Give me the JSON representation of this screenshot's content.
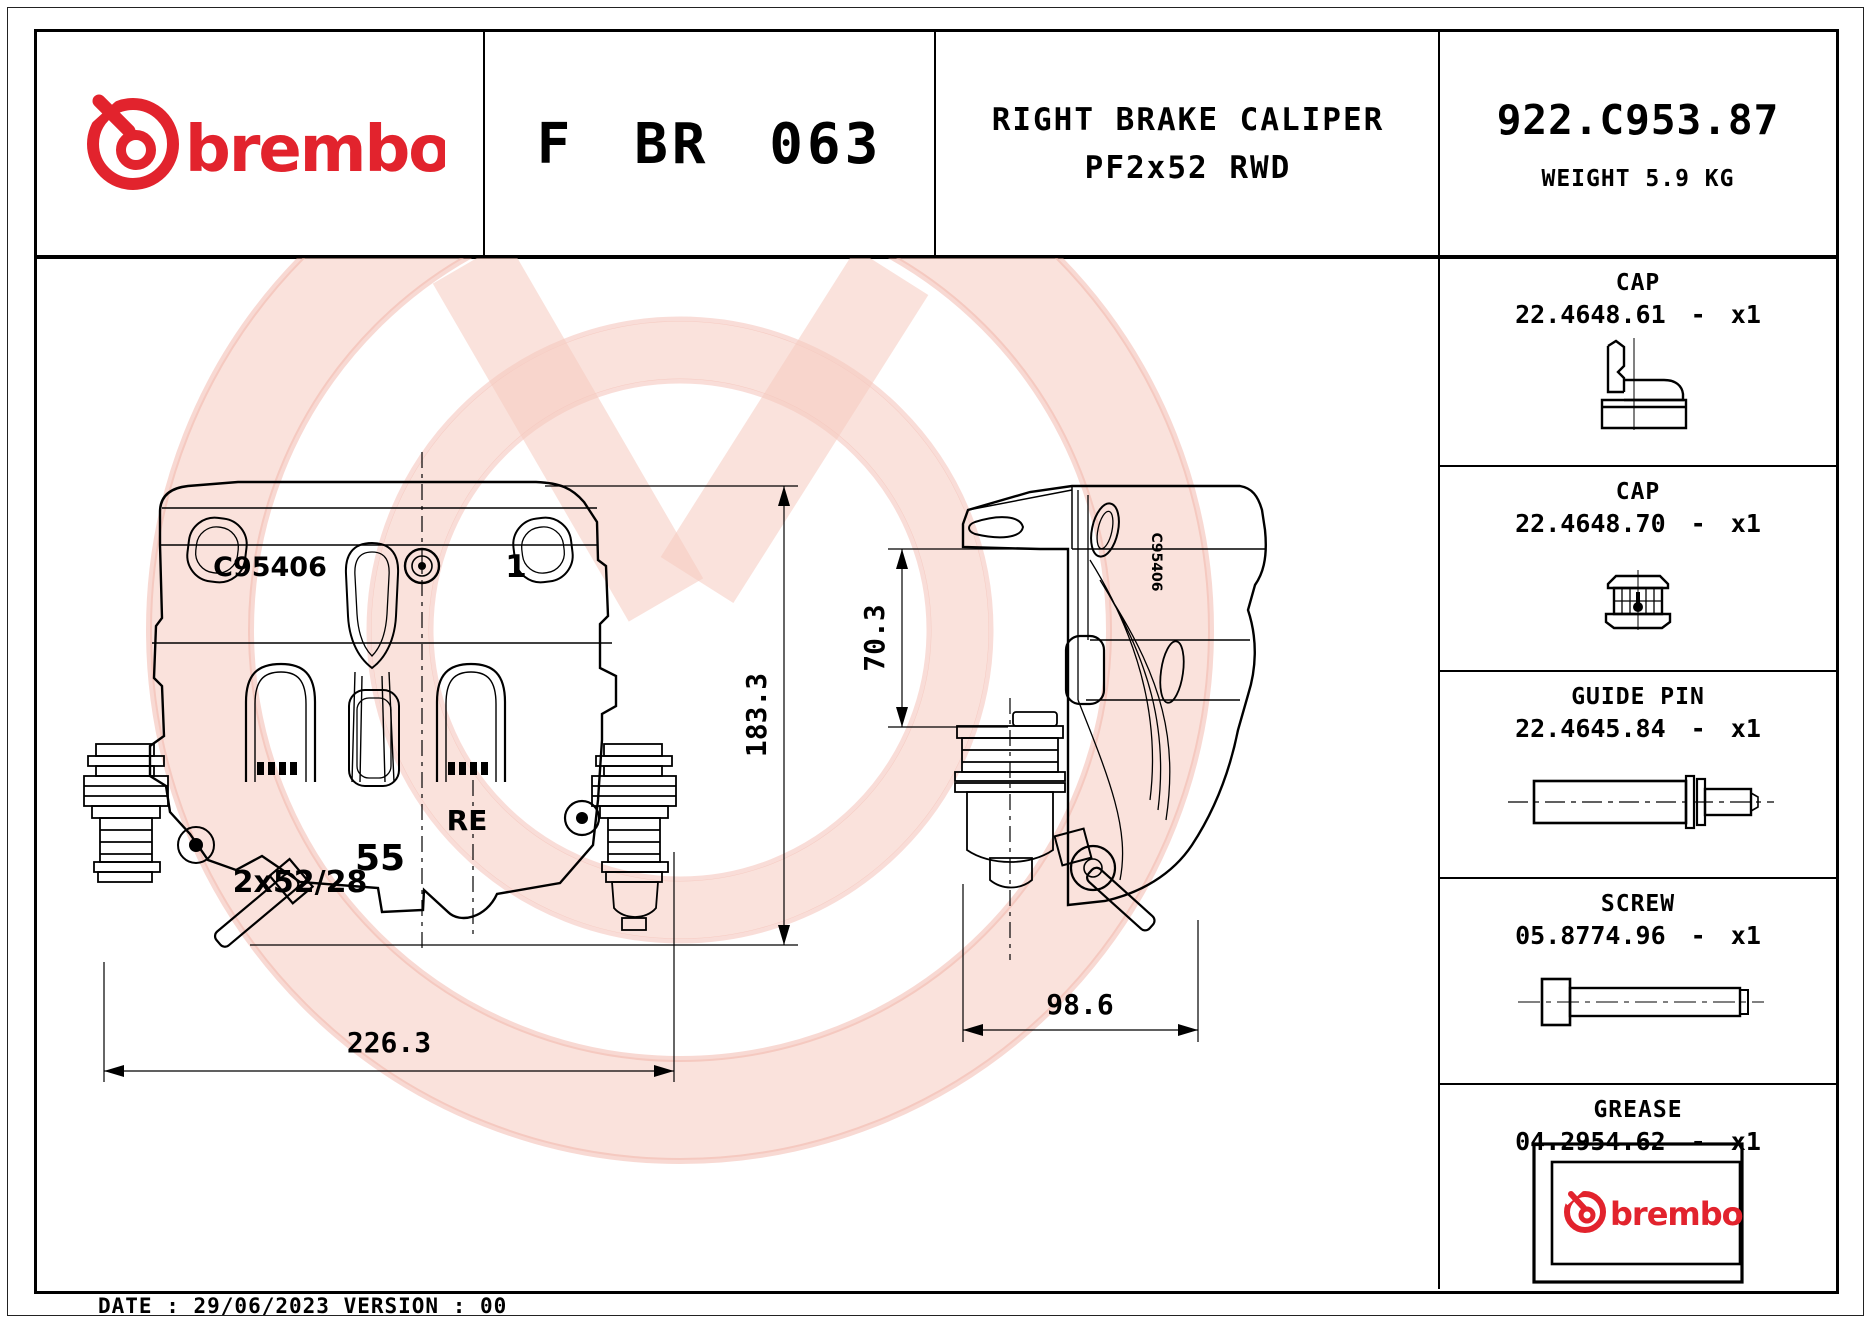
{
  "header": {
    "brand": "brembo",
    "product_code": "F BR 063",
    "title_line1": "RIGHT BRAKE CALIPER",
    "title_line2": "PF2x52 RWD",
    "part_number": "922.C953.87",
    "weight_label": "WEIGHT 5.9 KG"
  },
  "drawing": {
    "front_view": {
      "casting_code": "C95406",
      "cavity_mark": "1",
      "side_mark": "RE",
      "pad_mark": "55",
      "piston_mark": "2x52/28",
      "width_dim": "226.3",
      "height_dim": "183.3"
    },
    "side_view": {
      "casting_code": "C95406",
      "mount_dim": "70.3",
      "depth_dim": "98.6"
    }
  },
  "parts": [
    {
      "label": "CAP",
      "code": "22.4648.61 - x1"
    },
    {
      "label": "CAP",
      "code": "22.4648.70 - x1"
    },
    {
      "label": "GUIDE PIN",
      "code": "22.4645.84 - x1"
    },
    {
      "label": "SCREW",
      "code": "05.8774.96 - x1"
    },
    {
      "label": "GREASE",
      "code": "04.2954.62 - x1",
      "brand": "brembo"
    }
  ],
  "page": {
    "footer": "DATE : 29/06/2023 VERSION : 00"
  },
  "colors": {
    "brand_red": "#e2232d",
    "line_black": "#000000",
    "watermark_pink": "#f6cabf"
  }
}
